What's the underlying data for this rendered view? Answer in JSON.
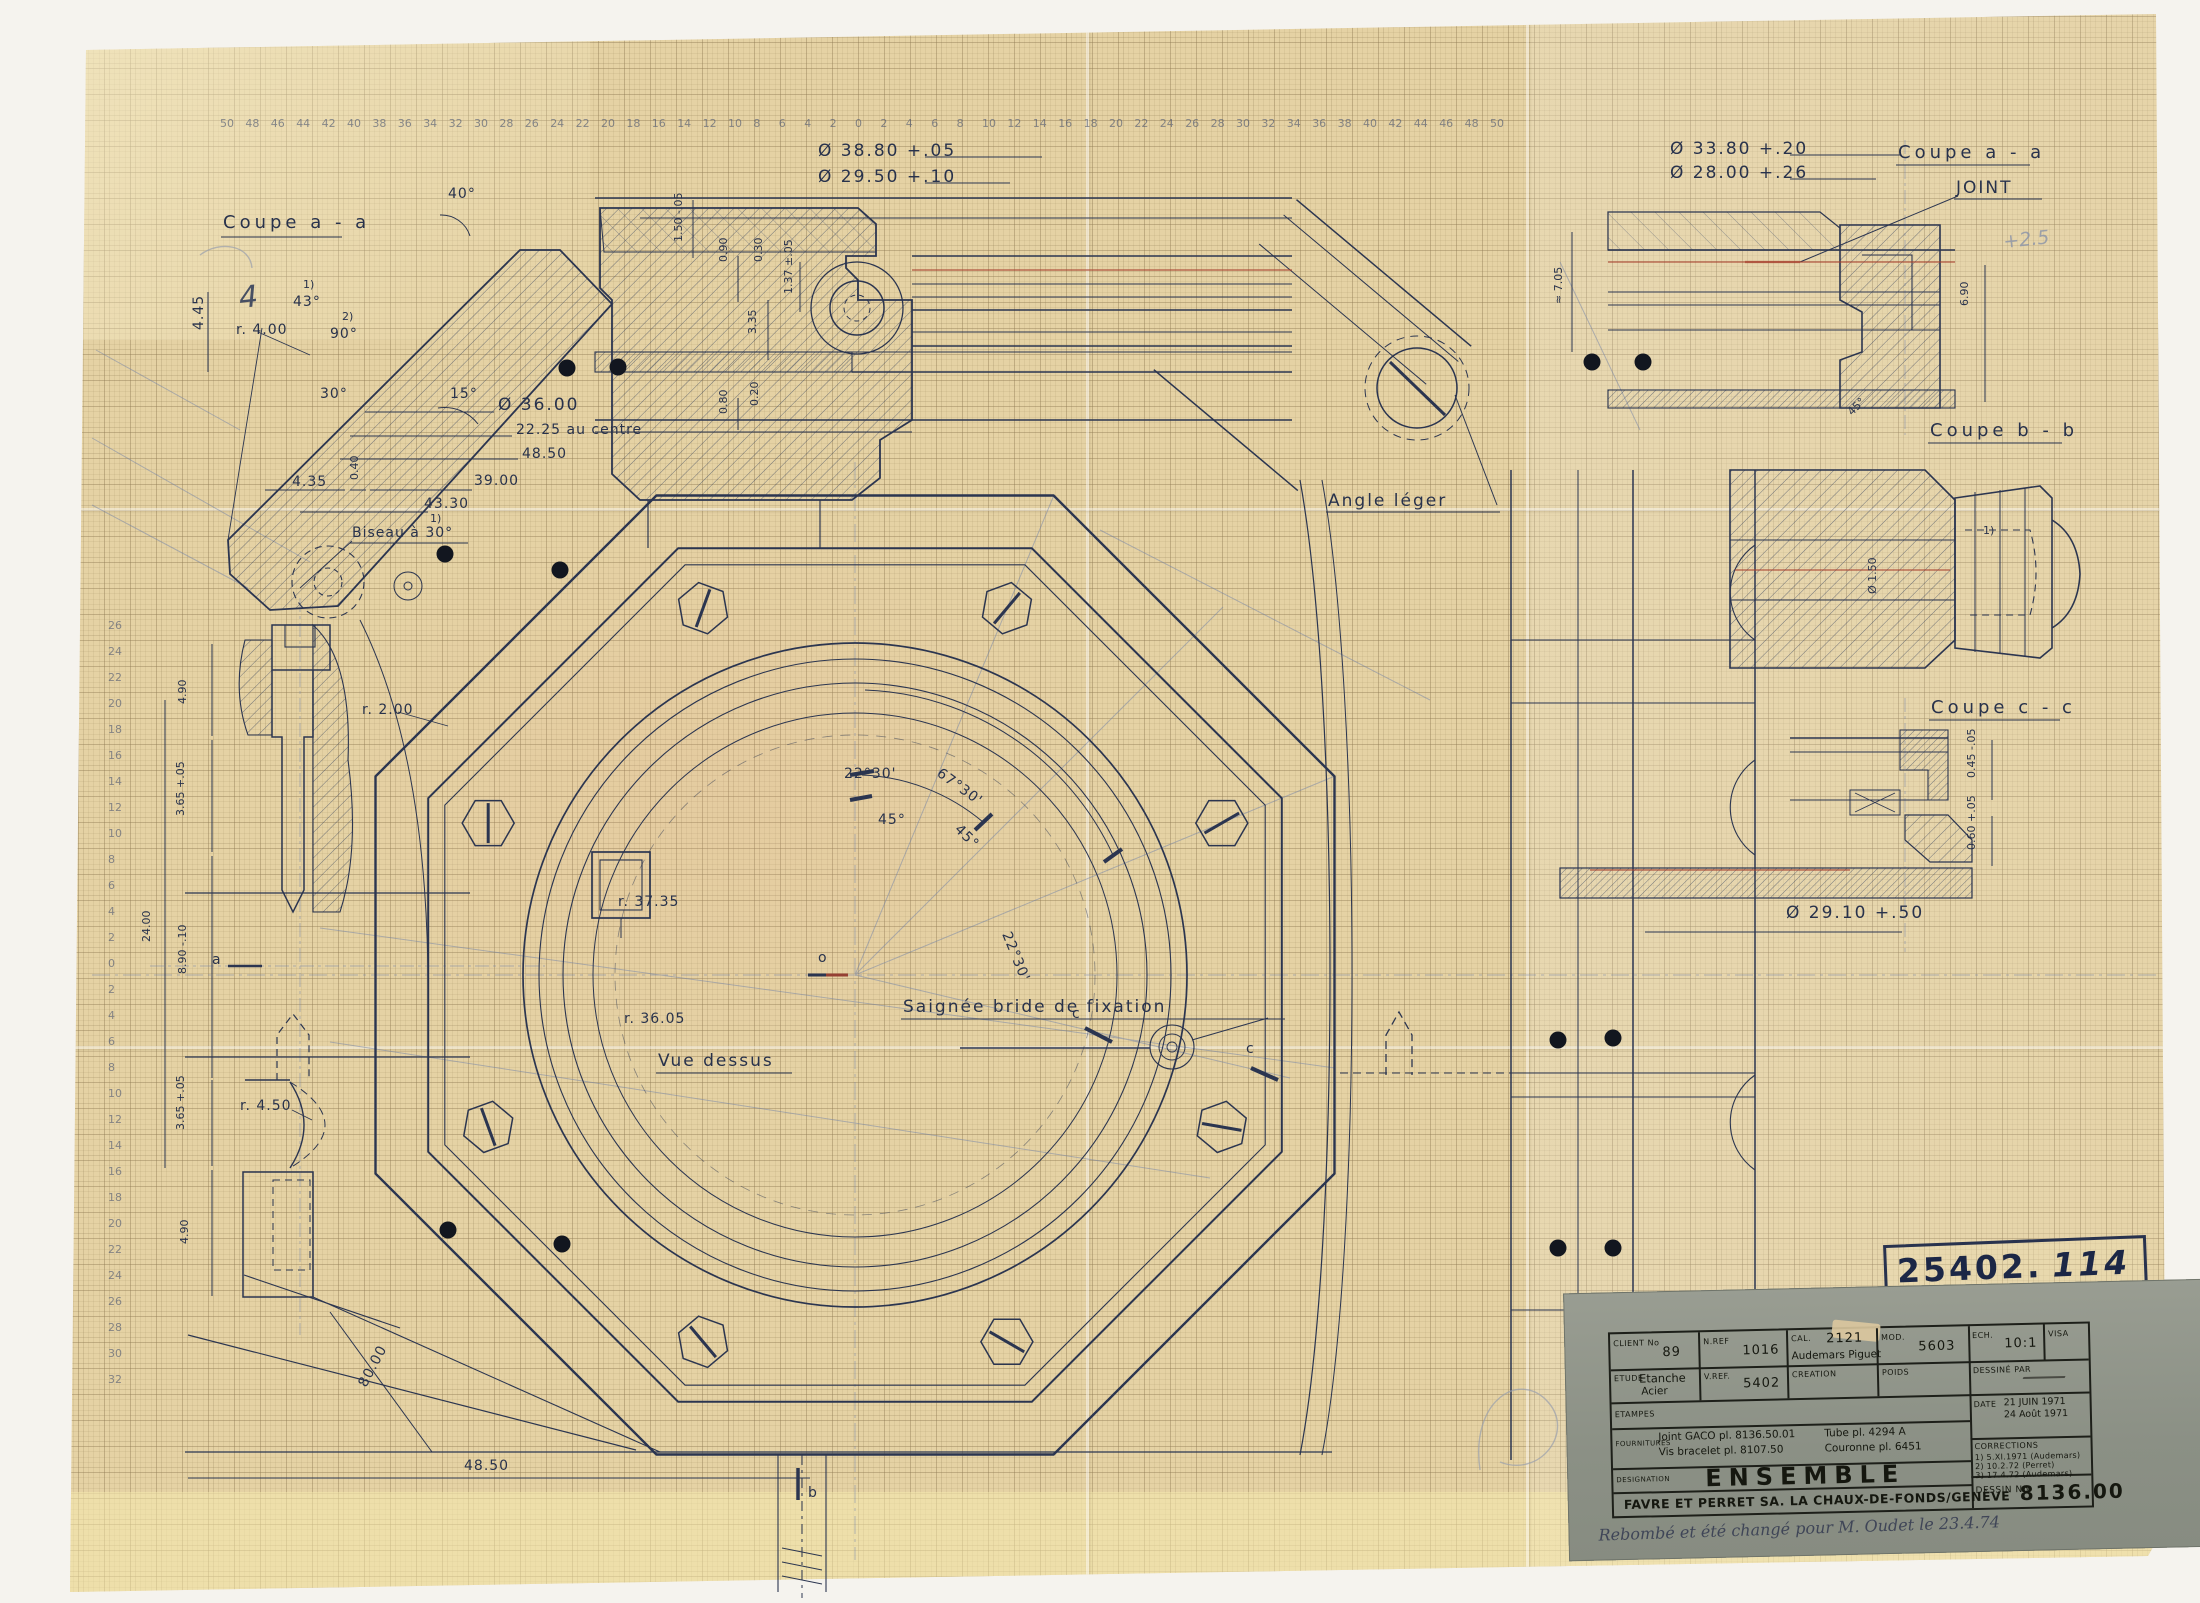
{
  "labels": {
    "coupe_aa_left": "Coupe  a - a",
    "coupe_aa_right": "Coupe  a - a",
    "coupe_bb": "Coupe  b - b",
    "coupe_cc": "Coupe  c - c",
    "joint": "JOINT",
    "angle_leger": "Angle  léger",
    "vue_dessus": "Vue  dessus",
    "saignee": "Saignée  bride  de  fixation",
    "biseau": "Biseau  à  30°",
    "note_1": "1)",
    "note_2": "2)",
    "sec_a": "a",
    "sec_b": "b",
    "sec_c": "c",
    "center_o": "o",
    "pencil_4": "4",
    "pencil_25": "+2.5"
  },
  "dims": {
    "d3880": "Ø  38.80 +.05",
    "d2950": "Ø  29.50 +.10",
    "d3380": "Ø  33.80 +.20",
    "d2800": "Ø  28.00 +.26",
    "d3600": "Ø  36.00",
    "d2225": "22.25  au  centre",
    "d4850": "48.50",
    "d3900": "39.00",
    "d4330": "43.30",
    "d435": "4.35",
    "d040": "0.40",
    "d445": "4.45",
    "dr400": "r. 4.00",
    "a40": "40°",
    "a43": "43°",
    "a90": "90°",
    "a30": "30°",
    "a15": "15°",
    "a45s": "45°",
    "d150": "1.50 -.05",
    "d090": "0.90",
    "d030": "0.30",
    "d335": "3.35",
    "d137": "1.37 ±.05",
    "d080": "0.80",
    "d020": "0.20",
    "d705": "≈ 7.05",
    "d690": "6.90",
    "d490": "4.90",
    "d365": "3.65 +.05",
    "d2400": "24.00",
    "d890": "8.90 -.10",
    "dr200": "r. 2.00",
    "dr450": "r. 4.50",
    "d365b": "3.65 +.05",
    "d490b": "4.90",
    "dr3735": "r. 37.35",
    "dr3605": "r. 36.05",
    "a2230": "22°30'",
    "a6730": "67°30'",
    "a45": "45°",
    "a45b": "45°",
    "a2230b": "22°30'",
    "d4850b": "48.50",
    "d8000": "80.00",
    "d2910": "Ø 29.10 +.50",
    "d045": "0.45 -.05",
    "d060": "0.60 +.05",
    "d150c": "Ø 1.50"
  },
  "stamp": {
    "prefix": "25402.",
    "number": "114"
  },
  "title_block": {
    "client_label": "CLIENT No",
    "client": "89",
    "nref_label": "N.REF",
    "nref": "1016",
    "cal_label": "CAL.",
    "cal": "2121",
    "cal_sub": "Audemars Piguet",
    "mod_label": "MOD.",
    "mod": "5603",
    "ech_label": "ECH.",
    "ech": "10:1",
    "visa_label": "VISA",
    "etude_label": "ETUDE",
    "etude": "Etanche",
    "etude2": "Acier",
    "vref_label": "V.REF.",
    "vref": "5402",
    "creation_label": "CREATION",
    "poids_label": "POIDS",
    "dessine_label": "DESSINÉ PAR",
    "etampes_label": "ETAMPES",
    "date_label": "DATE",
    "date1": "21 JUIN 1971",
    "date2": "24 Août 1971",
    "fournitures_label": "FOURNITURES",
    "f1": "Joint GACO pl. 8136.50.01",
    "f2": "Vis bracelet pl. 8107.50",
    "f3": "Tube pl. 4294 A",
    "f4": "Couronne pl. 6451",
    "corrections_label": "CORRECTIONS",
    "corr1": "1) 5.XI.1971  (Audemars)",
    "corr2": "2) 10.2.72    (Perret)",
    "corr3": "3) 17.4.72    (Audemars)",
    "designation_label": "DESIGNATION",
    "designation": "ENSEMBLE",
    "company": "FAVRE ET PERRET SA. LA CHAUX-DE-FONDS/GENÈVE",
    "dessin_label": "DESSIN No",
    "dessin_no": "8136.00",
    "handwritten_note": "Rebombé et été changé pour M. Oudet le 23.4.74"
  },
  "rulers": {
    "top": {
      "y": 127,
      "x0": 220,
      "step": 25.4,
      "values": [
        50,
        48,
        46,
        44,
        42,
        40,
        38,
        36,
        34,
        32,
        30,
        28,
        26,
        24,
        22,
        20,
        18,
        16,
        14,
        12,
        10,
        8,
        6,
        4,
        2,
        0,
        2,
        4,
        6,
        8,
        10,
        12,
        14,
        16,
        18,
        20,
        22,
        24,
        26,
        28,
        30,
        32,
        34,
        36,
        38,
        40,
        42,
        44,
        46,
        48,
        50
      ]
    },
    "left": {
      "x": 108,
      "y0": 629,
      "step": 26,
      "values": [
        26,
        24,
        22,
        20,
        18,
        16,
        14,
        12,
        10,
        8,
        6,
        4,
        2,
        0,
        2,
        4,
        6,
        8,
        10,
        12,
        14,
        16,
        18,
        20,
        22,
        24,
        26,
        28,
        30,
        32
      ]
    }
  },
  "dots": [
    [
      567,
      368
    ],
    [
      618,
      367
    ],
    [
      1592,
      362
    ],
    [
      1643,
      362
    ],
    [
      445,
      554
    ],
    [
      560,
      570
    ],
    [
      448,
      1230
    ],
    [
      562,
      1244
    ],
    [
      1558,
      1040
    ],
    [
      1613,
      1038
    ],
    [
      1558,
      1248
    ],
    [
      1613,
      1248
    ]
  ]
}
